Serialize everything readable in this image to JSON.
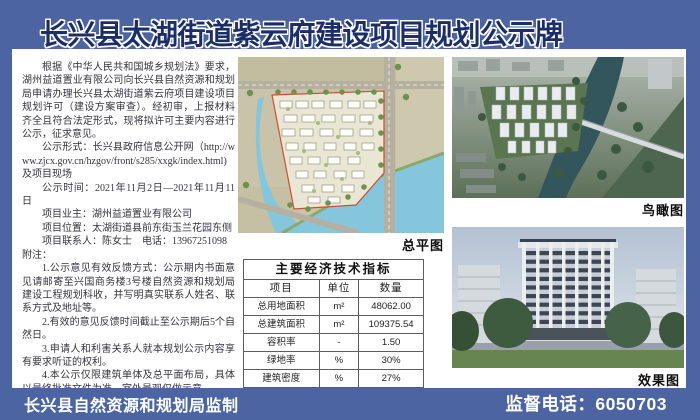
{
  "title": "长兴县太湖街道紫云府建设项目规划公示牌",
  "left_column": {
    "paragraphs": [
      {
        "text": "根据《中华人民共和国城乡规划法》要求，湖州益道置业有限公司向长兴县自然资源和规划局申请办理长兴县太湖街道紫云府项目建设项目规划许可（建设方案审查）。经初审，上报材料齐全且符合法定形式，现将拟许可主要内容进行公示，征求意见。",
        "indent": true
      },
      {
        "text": "公示形式：长兴县政府信息公开网（http://www.zjcx.gov.cn/hzgov/front/s285/xxgk/index.html)及项目现场",
        "indent": true
      },
      {
        "text": "公示时间：2021年11月2日—2021年11月11日",
        "indent": true
      },
      {
        "text": "项目业主：湖州益道置业有限公司",
        "indent": true
      },
      {
        "text": "项目位置：太湖街道县前东街玉兰花园东侧",
        "indent": true
      },
      {
        "text": "项目联系人：陈女士　电话：13967251098",
        "indent": true
      },
      {
        "text": "附注：",
        "indent": false
      },
      {
        "text": "1.公示意见有效反馈方式：公示期内书面意见请邮寄至兴国商务楼3号楼自然资源和规划局建设工程规划科收，并写明真实联系人姓名、联系方式及地址等。",
        "indent": true
      },
      {
        "text": "2.有效的意见反馈时间截止至公示期后5个自然日。",
        "indent": true
      },
      {
        "text": "3.申请人和利害关系人就本规划公示内容享有要求听证的权利。",
        "indent": true
      },
      {
        "text": "4.本公示仅限建筑单体及总平面布局，具体以最终批准文件为准，室外景观仅做示意。",
        "indent": true
      }
    ]
  },
  "images": {
    "site_plan_label": "总平图",
    "aerial_label": "鸟瞰图",
    "render_label": "效果图"
  },
  "table": {
    "title": "主要经济技术指标",
    "headers": [
      "项目",
      "单位",
      "数量"
    ],
    "rows": [
      [
        "总用地面积",
        "m²",
        "48062.00"
      ],
      [
        "总建筑面积",
        "m²",
        "109375.54"
      ],
      [
        "容积率",
        "-",
        "1.50"
      ],
      [
        "绿地率",
        "%",
        "30%"
      ],
      [
        "建筑密度",
        "%",
        "27%"
      ]
    ]
  },
  "footer": {
    "issuer": "长兴县自然资源和规划局监制",
    "phone": "监督电话：6050703"
  },
  "colors": {
    "background": "#4c65a2",
    "title_text": "#1c2e67",
    "footer_text": "#ffffff",
    "water": "#86c6dc",
    "boundary_red": "#cc4f35"
  }
}
